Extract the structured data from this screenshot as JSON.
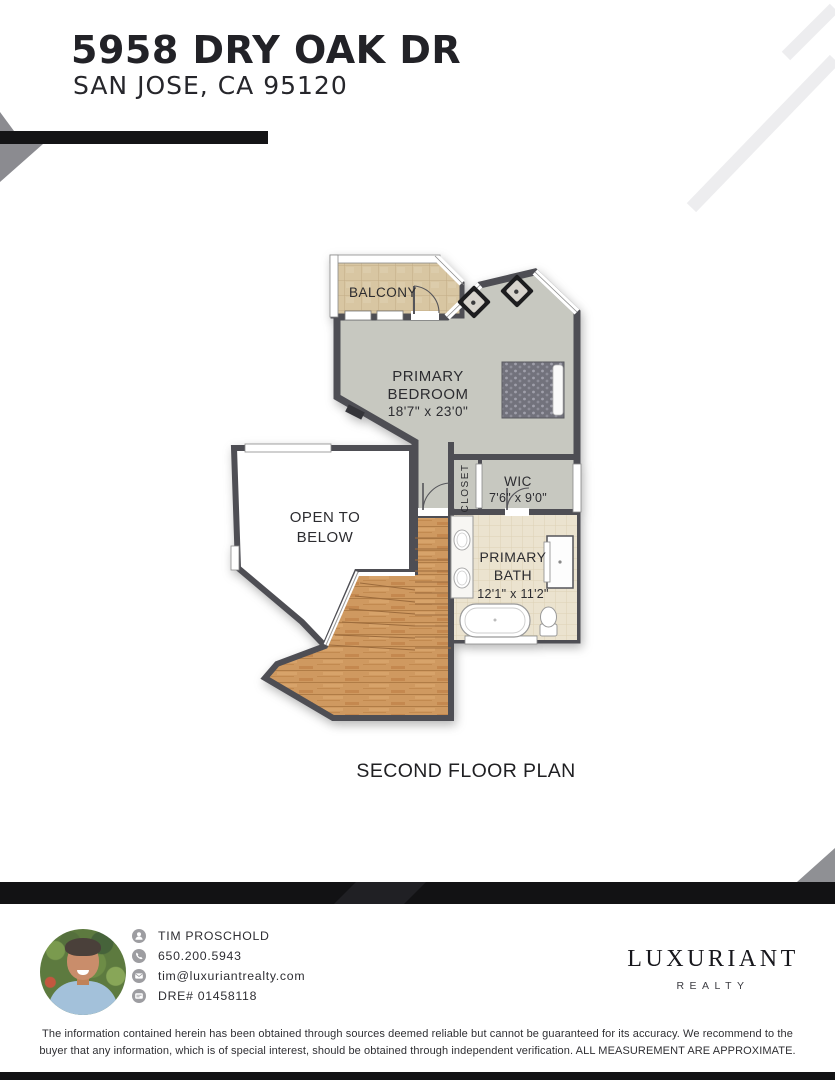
{
  "header": {
    "address_line1": "5958 DRY OAK DR",
    "address_line2": "SAN JOSE, CA 95120"
  },
  "floor_plan": {
    "caption": "SECOND FLOOR PLAN",
    "rooms": {
      "balcony": {
        "label": "BALCONY"
      },
      "primary_bedroom": {
        "label_line1": "PRIMARY",
        "label_line2": "BEDROOM",
        "dimensions": "18'7\" x 23'0\""
      },
      "open_to_below": {
        "label_line1": "OPEN TO",
        "label_line2": "BELOW"
      },
      "closet": {
        "label": "CLOSET"
      },
      "wic": {
        "label": "WIC",
        "dimensions": "7'6\" x 9'0\""
      },
      "primary_bath": {
        "label_line1": "PRIMARY",
        "label_line2": "BATH",
        "dimensions": "12'1\" x 11'2\""
      }
    }
  },
  "agent": {
    "name": "TIM PROSCHOLD",
    "phone": "650.200.5943",
    "email": "tim@luxuriantrealty.com",
    "dre": "DRE# 01458118"
  },
  "brand": {
    "name": "LUXURIANT",
    "tagline": "REALTY"
  },
  "disclaimer": {
    "line1": "The information contained herein has been obtained through sources deemed reliable but cannot be guaranteed for its accuracy. We recommend to the",
    "line2": "buyer that any information, which is of special interest, should be obtained through independent verification. ALL MEASUREMENT ARE APPROXIMATE."
  },
  "colors": {
    "accent_black": "#141416",
    "wall_gray": "#4e4e54",
    "carpet": "#c7c8c0",
    "balcony_tile": "#d8c6a2",
    "bath_tile": "#ebe3cf",
    "wood": "#cf9960",
    "deco_gray": "#8b8b90",
    "stripe_gray": "#ededef"
  }
}
